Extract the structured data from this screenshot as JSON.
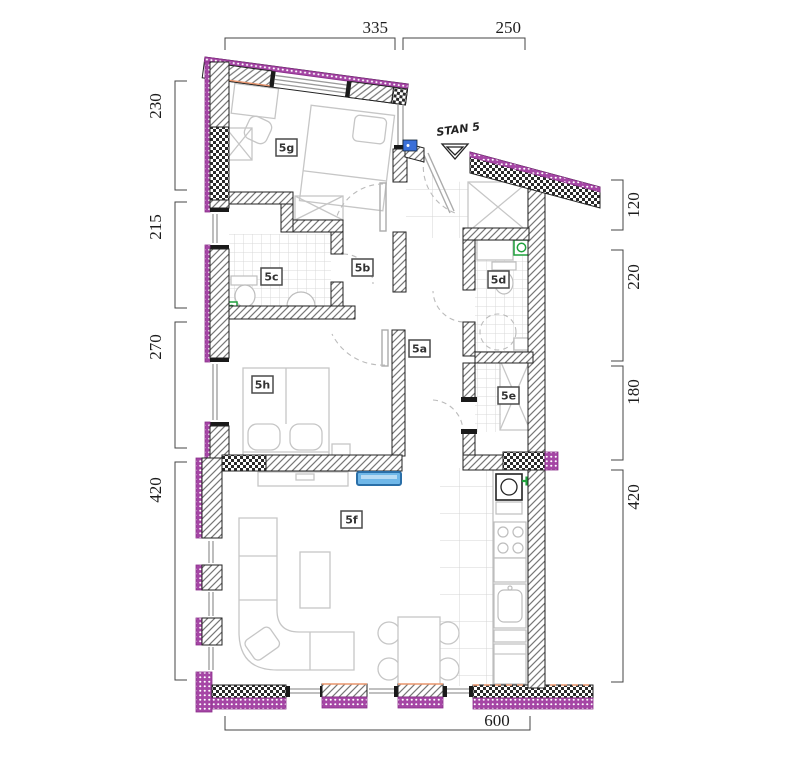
{
  "title": "STAN 5",
  "room_labels": {
    "a": "5a",
    "b": "5b",
    "c": "5c",
    "d": "5d",
    "e": "5e",
    "f": "5f",
    "g": "5g",
    "h": "5h"
  },
  "dimensions": {
    "top": [
      "335",
      "250"
    ],
    "left": [
      "230",
      "215",
      "270",
      "420"
    ],
    "right": [
      "120",
      "220",
      "180",
      "420"
    ],
    "bottom": [
      "600"
    ]
  },
  "colors": {
    "wall_accent": "#A546A5",
    "wall_accent_dark": "#8A2E8A",
    "radiator_blue": "#6FB7E8",
    "fixture_green": "#1FA13C",
    "door_blue": "#3A6FD8",
    "insulation_orange": "#E8956D"
  }
}
